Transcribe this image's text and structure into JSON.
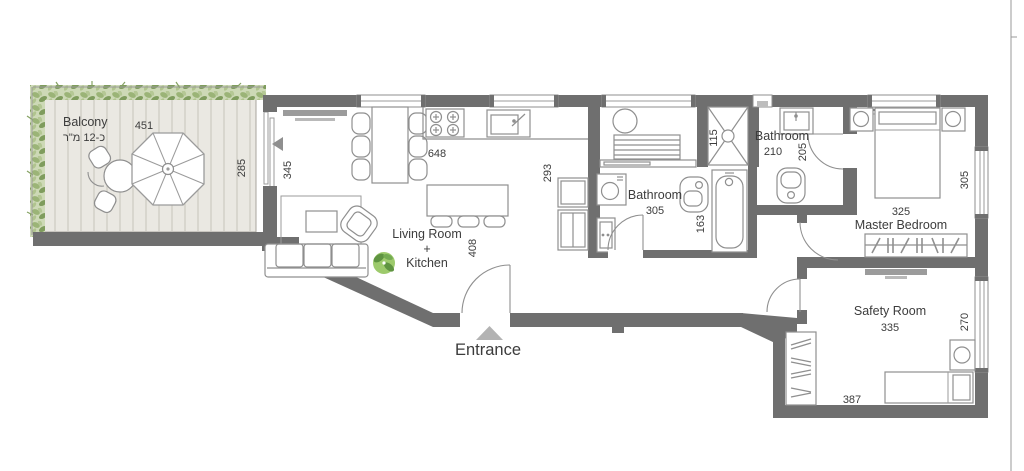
{
  "plan_title": "Apartment floor plan",
  "colors": {
    "wall": "#6f6f6f",
    "deck": "#eae8e2",
    "deck_plank": "#c6c3ba",
    "foliage_light": "#b9cb9c",
    "foliage_dark": "#86a263",
    "plant_accent": "#6aa84f",
    "label_text": "#3c3c3c",
    "furniture_stroke": "#8f8f8f",
    "entrance_marker": "#b3b3b3"
  },
  "rooms": {
    "balcony": {
      "label": "Balcony",
      "area_note": "כ-12 מ\"ר",
      "dim_width": "451",
      "dim_depth": "285"
    },
    "living_kitchen": {
      "line1": "Living Room",
      "line2": "+",
      "line3": "Kitchen",
      "dim_left": "345",
      "dim_top": "648",
      "dim_right": "293",
      "dim_mid": "408"
    },
    "bathroom_main": {
      "label": "Bathroom",
      "size": "305",
      "dim_tub": "163"
    },
    "shower": {
      "dim": "115"
    },
    "bathroom_second": {
      "label": "Bathroom",
      "size": "210",
      "dim_side": "205"
    },
    "master_bedroom": {
      "label": "Master Bedroom",
      "size": "325",
      "dim_right": "305"
    },
    "safety_room": {
      "label": "Safety Room",
      "size": "335",
      "dim_right": "270",
      "dim_bottom": "387"
    },
    "entrance": {
      "label": "Entrance"
    }
  }
}
